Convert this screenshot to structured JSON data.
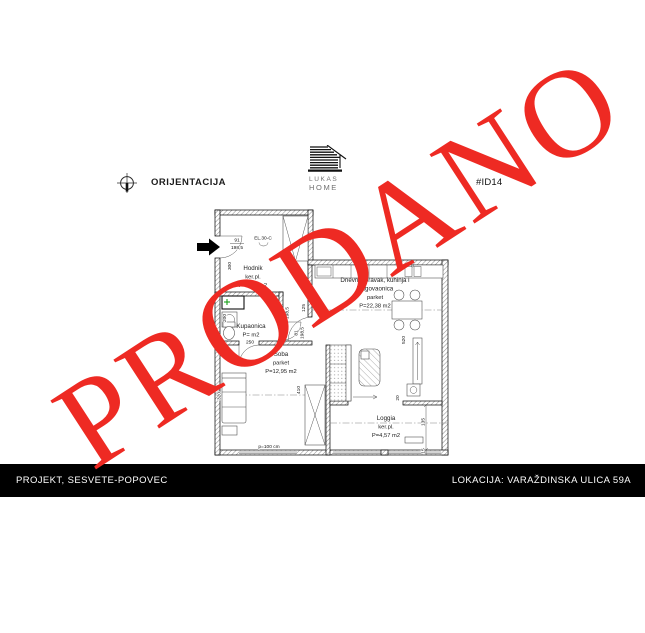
{
  "header": {
    "orientation_label": "ORIJENTACIJA",
    "logo": {
      "line1": "LUKAS",
      "line2": "HOME"
    },
    "unit_id": "#ID14"
  },
  "watermark": {
    "text": "PRODANO"
  },
  "colors": {
    "watermark_red": "#ee2a23",
    "footer_bg": "#000000"
  },
  "plan": {
    "rooms": {
      "hodnik": {
        "name": "Hodnik",
        "floor": "ker.pl.",
        "area": "P=7,57 m2"
      },
      "kupaonica": {
        "name": "Kupaonica",
        "area": "P= m2"
      },
      "soba": {
        "name": "Soba",
        "floor": "parket",
        "area": "P=12,95 m2"
      },
      "dnevni": {
        "name1": "Dnevni boravak, kuhinja i",
        "name2": "blagovaonica",
        "floor": "parket",
        "area": "P=22,38 m2"
      },
      "loggia": {
        "name": "Loggia",
        "floor": "ker.pl.",
        "area": "P=4,57 m2"
      }
    },
    "dims": {
      "d300": "300",
      "d200": "200",
      "d250": "250",
      "d320": "320",
      "d410": "410",
      "d520": "520",
      "d125": "125",
      "d135": "135",
      "d20": "20",
      "d15": "15"
    },
    "doors": {
      "entrance_w": "91",
      "entrance_h": "198,5",
      "living_w": "81",
      "living_h": "198,5",
      "bath_w": "71",
      "bath_h": "198,5"
    },
    "labels": {
      "electric": "EL.30-C",
      "parapet": "p=100 cm"
    }
  },
  "footer": {
    "left": "PROJEKT, SESVETE-POPOVEC",
    "right": "LOKACIJA: VARAŽDINSKA ULICA 59A"
  }
}
